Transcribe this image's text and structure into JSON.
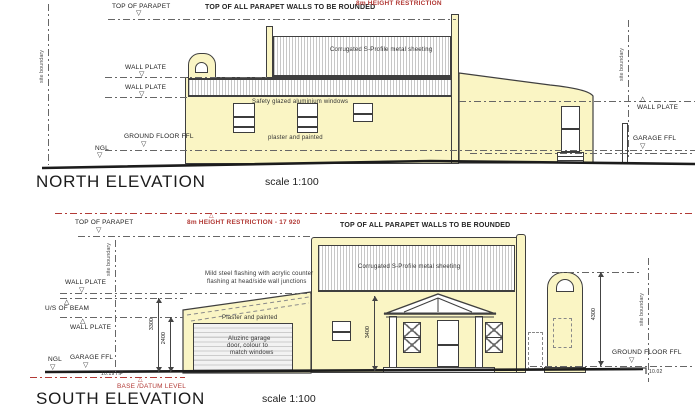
{
  "colors": {
    "wall": "#faf5c4",
    "line": "#3f3f3f",
    "red": "#b23a36"
  },
  "icons": {
    "level_down": "▽",
    "level_up": "△"
  },
  "north": {
    "title": "NORTH ELEVATION",
    "scale": "scale 1:100",
    "parapet_note": "TOP OF ALL PARAPET WALLS TO BE ROUNDED",
    "height_restriction": "8m HEIGHT RESTRICTION",
    "roof_material": "Corrugated S-Profile metal sheeting",
    "clerestory_note": "Safety glazed aluminium windows",
    "wall_finish": "plaster and painted",
    "levels": {
      "top_of_parapet": "TOP OF PARAPET",
      "wall_plate": "WALL PLATE",
      "ground_floor_ffl": "GROUND FLOOR FFL",
      "ngl": "NGL",
      "garage_ffl": "GARAGE FFL"
    },
    "site_boundary": "site boundary"
  },
  "south": {
    "title": "SOUTH ELEVATION",
    "scale": "scale 1:100",
    "parapet_note": "TOP OF ALL PARAPET WALLS TO BE ROUNDED",
    "height_restriction": "8m HEIGHT RESTRICTION - 17 920",
    "roof_material": "Corrugated S-Profile metal sheeting",
    "flashing_note_1": "Mild steel flashing with acrylic counter",
    "flashing_note_2": "flashing at head/side wall junctions",
    "wall_finish": "Plaster and painted",
    "garage_door_1": "Aluzinc garage",
    "garage_door_2": "door, colour to",
    "garage_door_3": "match windows",
    "base_datum": "BASE /DATUM LEVEL",
    "levels": {
      "top_of_parapet": "TOP OF PARAPET",
      "wall_plate": "WALL PLATE",
      "us_of_beam": "U/S OF BEAM",
      "ngl": "NGL",
      "garage_ffl": "GARAGE FFL",
      "ground_floor_ffl": "GROUND FLOOR FFL"
    },
    "dimensions": {
      "d3300": "3300",
      "d2400": "2400",
      "d3400": "3400",
      "d4300": "4300",
      "hp": "10.19 HP",
      "right_level": "10.02"
    },
    "site_boundary": "site boundary"
  }
}
